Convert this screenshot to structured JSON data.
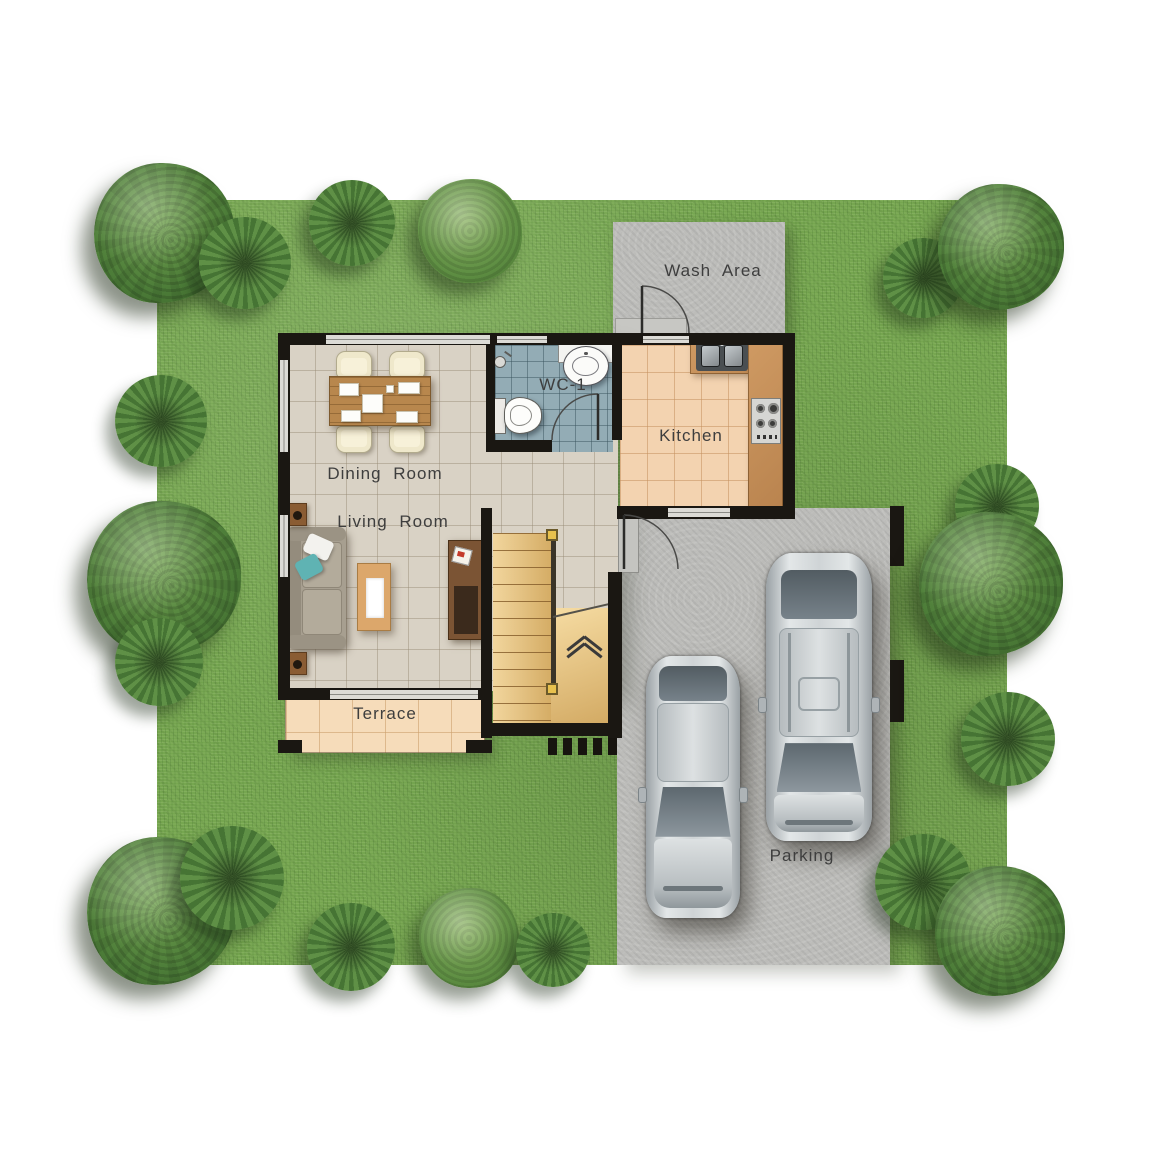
{
  "title": "House ground-floor plan, top view with garden and parking",
  "rooms": {
    "wash_area": {
      "label": "Wash Area"
    },
    "wc": {
      "label": "WC-1"
    },
    "kitchen": {
      "label": "Kitchen"
    },
    "dining_room": {
      "label": "Dining Room"
    },
    "living_room": {
      "label": "Living Room"
    },
    "terrace": {
      "label": "Terrace"
    },
    "parking": {
      "label": "Parking"
    }
  },
  "colors": {
    "grass": "#76a650",
    "tree_foliage": "#4c7c38",
    "concrete": "#bcbcb9",
    "floor_main": "#d9d2c5",
    "floor_kitchen": "#f3d3b0",
    "floor_wc": "#93acb5",
    "floor_terrace": "#f6dcba",
    "counter_wood": "#c08a52",
    "stair_wood": "#edc87d",
    "wall": "#1a1712",
    "label_text": "#3e3e3e",
    "car_silver": "#cfd4d6",
    "pillow_teal": "#5fb3b3"
  },
  "garden": {
    "trees": [
      {
        "x": 164,
        "y": 233,
        "r": 70,
        "type": "bushy"
      },
      {
        "x": 245,
        "y": 263,
        "r": 46,
        "type": "fern"
      },
      {
        "x": 352,
        "y": 223,
        "r": 43,
        "type": "fern"
      },
      {
        "x": 470,
        "y": 231,
        "r": 52,
        "type": "bushy2"
      },
      {
        "x": 923,
        "y": 278,
        "r": 40,
        "type": "fern"
      },
      {
        "x": 1001,
        "y": 247,
        "r": 63,
        "type": "bushy"
      },
      {
        "x": 161,
        "y": 421,
        "r": 46,
        "type": "fern"
      },
      {
        "x": 164,
        "y": 578,
        "r": 77,
        "type": "bushy"
      },
      {
        "x": 159,
        "y": 662,
        "r": 44,
        "type": "fern"
      },
      {
        "x": 161,
        "y": 911,
        "r": 74,
        "type": "bushy"
      },
      {
        "x": 232,
        "y": 878,
        "r": 52,
        "type": "fern"
      },
      {
        "x": 351,
        "y": 947,
        "r": 44,
        "type": "fern"
      },
      {
        "x": 469,
        "y": 938,
        "r": 50,
        "type": "bushy2"
      },
      {
        "x": 553,
        "y": 950,
        "r": 37,
        "type": "fern"
      },
      {
        "x": 923,
        "y": 882,
        "r": 48,
        "type": "fern"
      },
      {
        "x": 1000,
        "y": 931,
        "r": 65,
        "type": "bushy"
      },
      {
        "x": 997,
        "y": 506,
        "r": 42,
        "type": "fern"
      },
      {
        "x": 991,
        "y": 584,
        "r": 72,
        "type": "bushy"
      },
      {
        "x": 1008,
        "y": 739,
        "r": 47,
        "type": "fern"
      }
    ]
  },
  "vehicles": [
    {
      "name": "sedan",
      "color": "silver"
    },
    {
      "name": "suv",
      "color": "silver"
    }
  ]
}
